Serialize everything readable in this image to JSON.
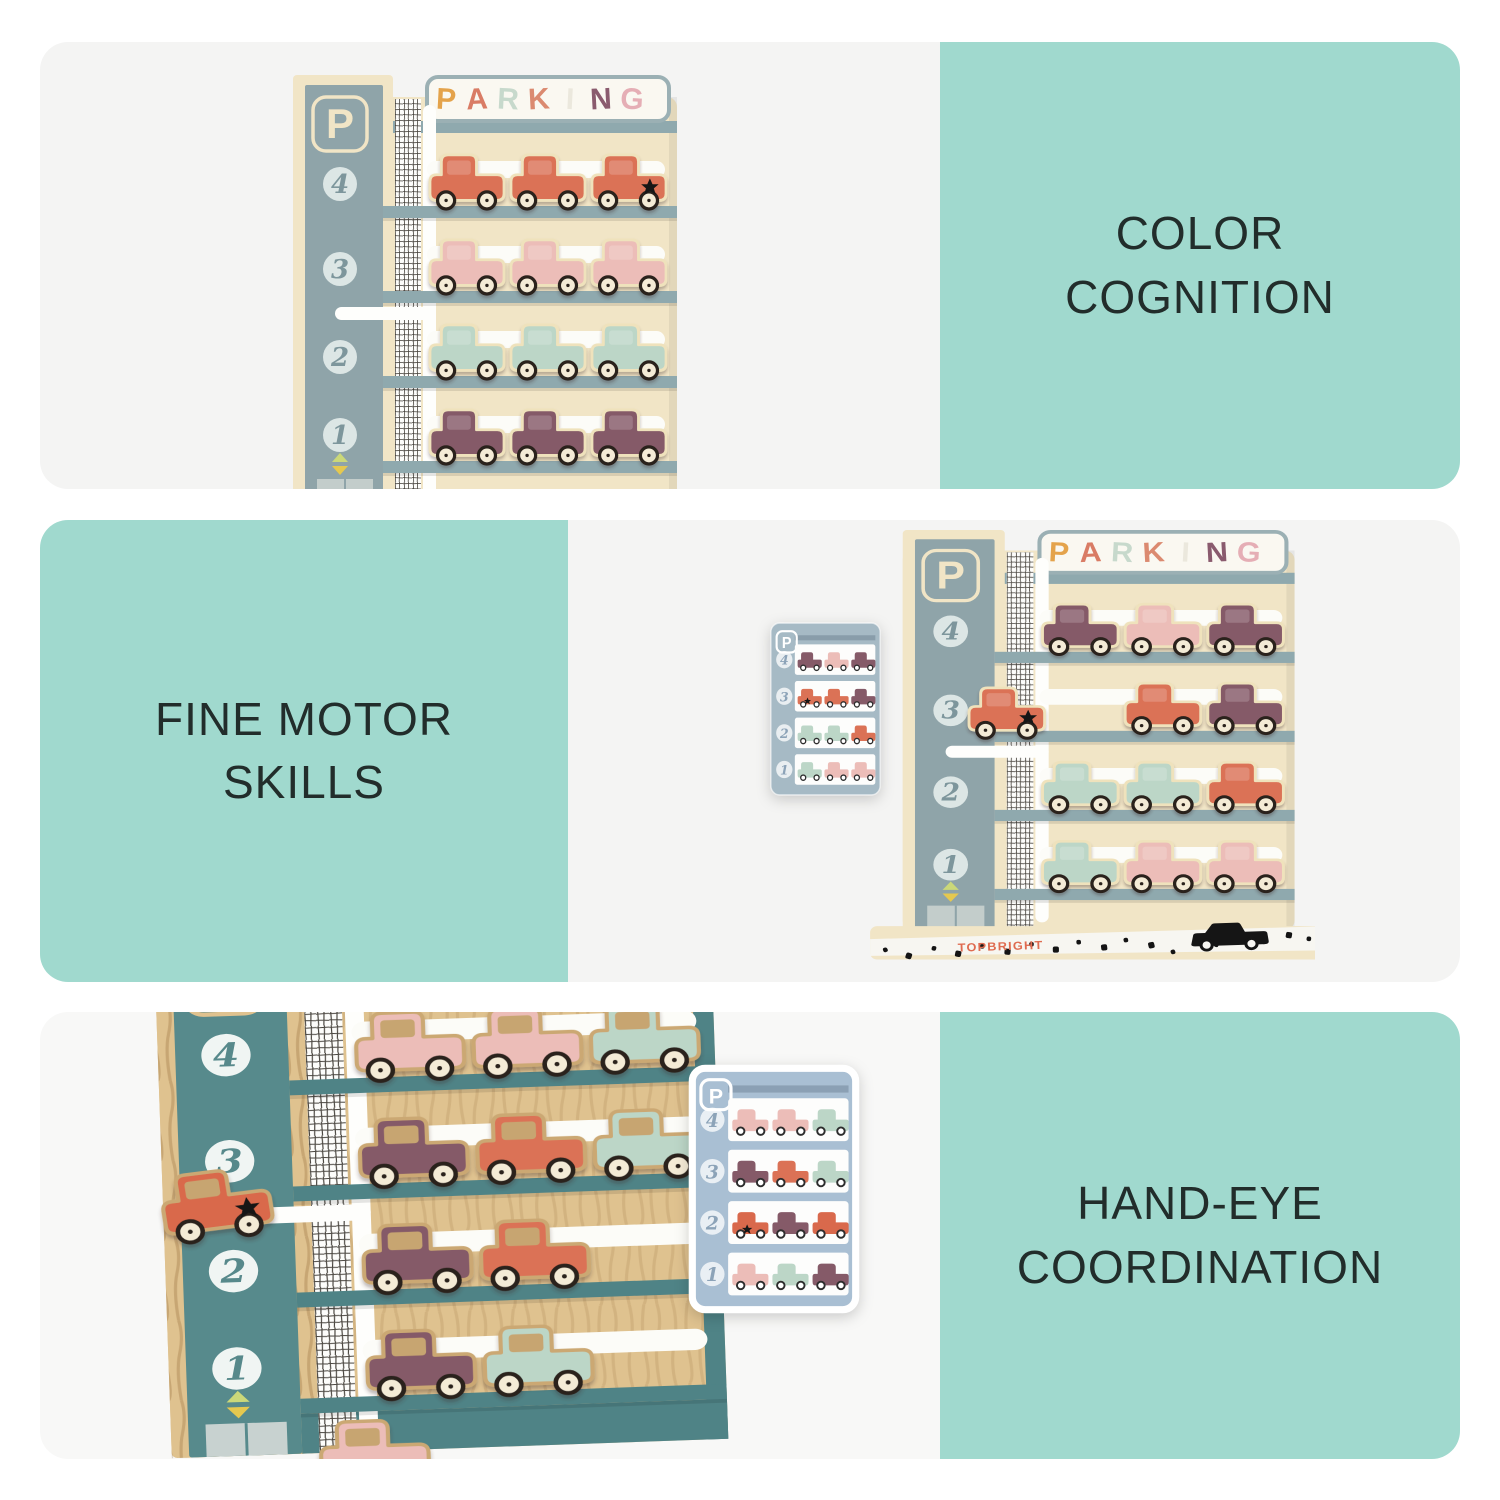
{
  "style": {
    "background": "#ffffff",
    "teal_panel": "#A0D9CE",
    "photo_panel": "#F4F4F3",
    "photo_panel_bottom": "#F8F8F7",
    "text_color": "#222D2B"
  },
  "sections": [
    {
      "name": "color-cognition",
      "line1": "COLOR",
      "line2": "COGNITION"
    },
    {
      "name": "fine-motor-skills",
      "line1": "FINE MOTOR",
      "line2": "SKILLS"
    },
    {
      "name": "hand-eye-coordination",
      "line1": "HAND-EYE",
      "line2": "COORDINATION"
    }
  ],
  "toy": {
    "p_label": "P",
    "floors": [
      "4",
      "3",
      "2",
      "1"
    ],
    "brand": "TOPBRIGHT",
    "brand_color": "#DF6B50",
    "sign_letters": [
      {
        "ch": "P",
        "color": "#E4A34B"
      },
      {
        "ch": "A",
        "color": "#D97C65"
      },
      {
        "ch": "R",
        "color": "#C7D9CC"
      },
      {
        "ch": "K",
        "color": "#DB8A70"
      },
      {
        "ch": "I",
        "color": "#EBE8DD"
      },
      {
        "ch": "N",
        "color": "#8A5B6E"
      },
      {
        "ch": "G",
        "color": "#E5AEB5"
      }
    ],
    "car_colors": {
      "coral": "#DB7256",
      "pink": "#ECBDB8",
      "mint": "#BCD6C7",
      "plum": "#855A68",
      "red": "#D9694C"
    },
    "palette_front": {
      "cream": "#F1E5C6",
      "column": "#8FA4A9",
      "shelf": "#8FA9AE",
      "slot": "#FCFCF8",
      "sign_bg": "#FAF8F1",
      "sign_border": "#9BB0B4",
      "circle_fill": "#DCE6E5",
      "circle_text": "#7D969C",
      "wheel": "#F4EBD6",
      "wheel_ring": "#2A211C",
      "doors": "#C3CDCB",
      "arrow_up": "#CBD879",
      "arrow_down": "#E5C84F",
      "outline": "#EFE2BC",
      "window": "#FFFFFF",
      "window_opacity": "0.18"
    },
    "palette_closeup": {
      "cream": "#DFC28F",
      "column": "#578A8C",
      "shelf": "#4F8386",
      "slot": "#FCFCF8",
      "sign_bg": "#FAF8F1",
      "sign_border": "#9BB0B4",
      "circle_fill": "#F0F5F3",
      "circle_text": "#57898B",
      "wheel": "#F4EBD6",
      "wheel_ring": "#2A211C",
      "doors": "#C8D2D0",
      "arrow_up": "#CBD879",
      "arrow_down": "#E5C84F",
      "outline": "#CBA873",
      "window": "#C7A571",
      "window_opacity": "1"
    },
    "rows_photo1": [
      [
        "coral",
        "coral",
        "coral*"
      ],
      [
        "pink",
        "pink",
        "pink"
      ],
      [
        "mint",
        "mint",
        "mint"
      ],
      [
        "plum",
        "plum",
        "plum"
      ]
    ],
    "rows_photo2": [
      [
        "plum",
        "pink",
        "plum"
      ],
      [
        "coral*",
        "coral",
        "plum"
      ],
      [
        "mint",
        "mint",
        "coral"
      ],
      [
        "mint",
        "pink",
        "pink"
      ]
    ],
    "rows_photo3": [
      [
        "pink",
        "pink",
        "mint"
      ],
      [
        "plum",
        "coral",
        "mint"
      ],
      [
        "plum",
        "coral",
        null
      ],
      [
        "plum",
        "mint",
        null
      ]
    ],
    "rows_card_bottom": [
      [
        "pink",
        "pink",
        "mint"
      ],
      [
        "plum",
        "coral",
        "mint"
      ],
      [
        "red*",
        "plum",
        "red"
      ],
      [
        "pink",
        "mint",
        "plum"
      ]
    ],
    "cards": {
      "middle_bg": "#A6BAC5",
      "bottom_bg": "#A9BFD3",
      "row_bg": "#FDFDFC",
      "number_color": "#8CA3B8",
      "roof_tint": "rgba(70,90,110,0.30)"
    }
  }
}
